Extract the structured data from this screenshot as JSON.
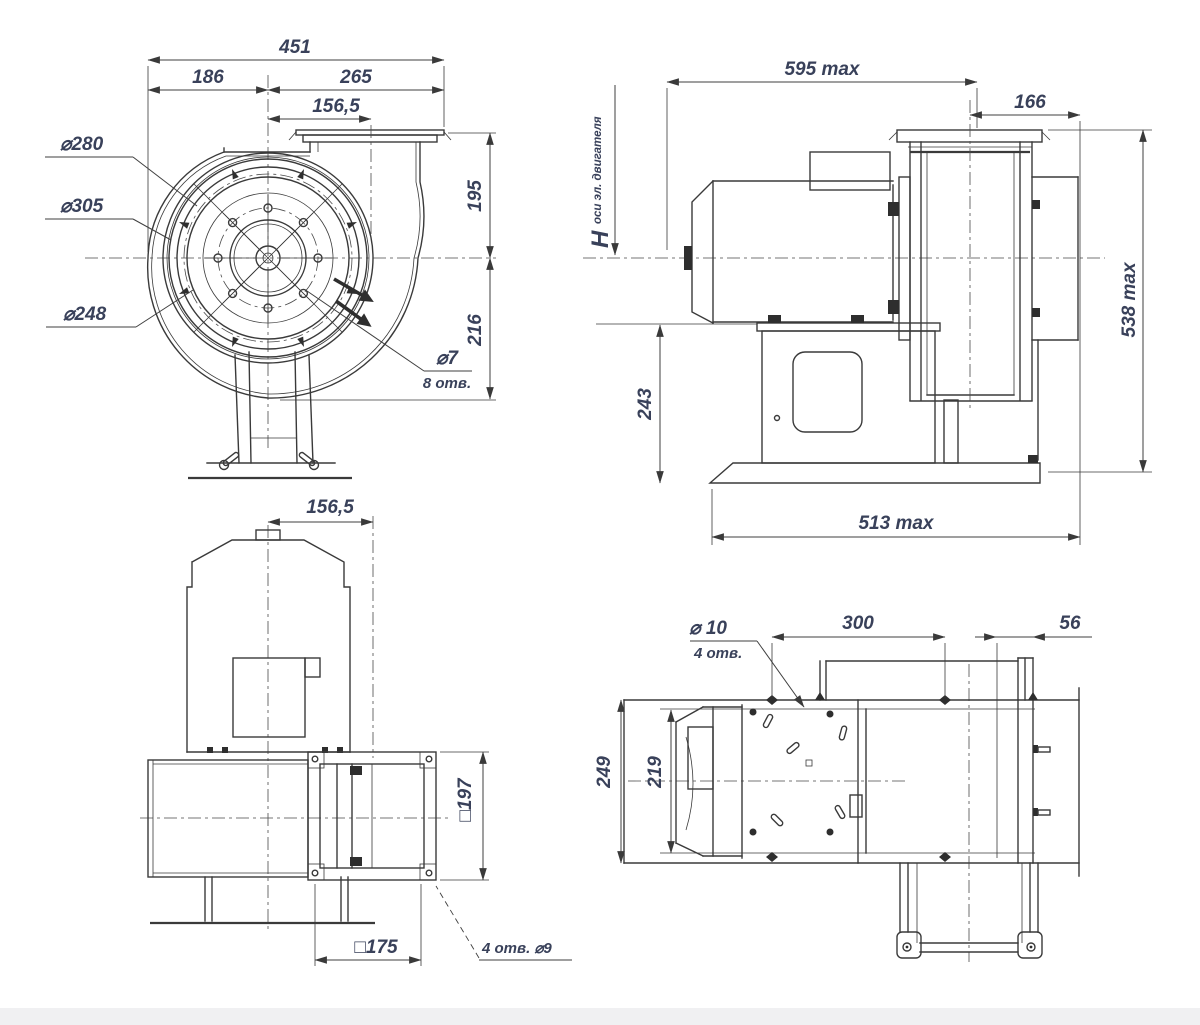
{
  "meta": {
    "type": "engineering-dimensional-drawing",
    "subject": "centrifugal-fan-four-views",
    "colors": {
      "line": "#3a3a3a",
      "text": "#39415a",
      "background": "#ffffff",
      "footer_bar": "#f0f0f2"
    }
  },
  "v1": {
    "total": "451",
    "left": "186",
    "right": "265",
    "offset": "156,5",
    "d280": "⌀280",
    "d305": "⌀305",
    "d248": "⌀248",
    "h_top": "195",
    "h_bot": "216",
    "hole": "⌀7",
    "hole_n": "8 отв."
  },
  "v2": {
    "len": "595 max",
    "outlet": "166",
    "h": "Н",
    "h_sub": "оси эл. двигателя",
    "base_h": "243",
    "height": "538 max",
    "base_len": "513 max"
  },
  "v3": {
    "offset": "156,5",
    "flange": "□197",
    "bolts": "□175",
    "holes": "4 отв. ⌀9"
  },
  "v4": {
    "hole": "⌀ 10",
    "hole_n": "4 отв.",
    "spacing": "300",
    "edge": "56",
    "base_w": "249",
    "motor_w": "219"
  }
}
